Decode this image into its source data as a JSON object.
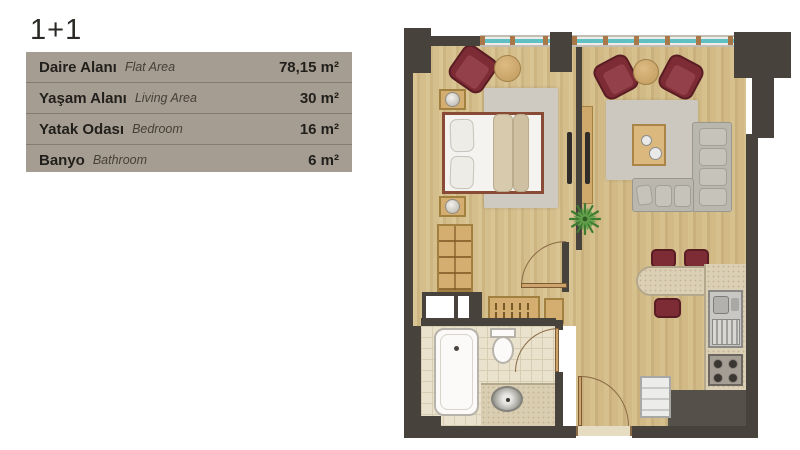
{
  "page": {
    "background": "#ffffff"
  },
  "header": {
    "title": "1+1"
  },
  "area_table": {
    "background": "#a69d92",
    "rows": [
      {
        "label_tr": "Daire Alanı",
        "label_en": "Flat Area",
        "value": "78,15 m²"
      },
      {
        "label_tr": "Yaşam Alanı",
        "label_en": "Living Area",
        "value": "30 m²"
      },
      {
        "label_tr": "Yatak Odası",
        "label_en": "Bedroom",
        "value": "16 m²"
      },
      {
        "label_tr": "Banyo",
        "label_en": "Bathroom",
        "value": "6 m²"
      }
    ]
  },
  "floorplan": {
    "colors": {
      "wall": "#48423d",
      "wood_floor": "#d4be8c",
      "window_glass": "#5fc0c3",
      "armchair_red": "#7d2c35",
      "sofa_gray": "#bab7af",
      "rug_gray": "#cecac2",
      "bathroom_tile": "#eae2cc",
      "counter": "#dbcfb5",
      "bed_frame": "#8a4b36"
    },
    "rooms": [
      "bedroom",
      "living-room",
      "hallway",
      "bathroom",
      "kitchen",
      "entrance"
    ],
    "elements": [
      "double-bed",
      "pillows",
      "duvet",
      "nightstands",
      "bedside-lamps",
      "bedroom-armchair",
      "round-side-tables",
      "bedroom-rug",
      "wardrobe",
      "tv-wall-unit",
      "living-armchairs",
      "sectional-sofa",
      "coffee-table",
      "living-rug",
      "potted-plant",
      "shoe-cabinet",
      "hall-cabinet",
      "bathtub",
      "toilet",
      "washbasin-counter",
      "breakfast-bar",
      "bar-chairs",
      "kitchen-sink",
      "stove",
      "washing-machine",
      "entrance-door",
      "bedroom-door",
      "bathroom-door",
      "windows"
    ]
  }
}
